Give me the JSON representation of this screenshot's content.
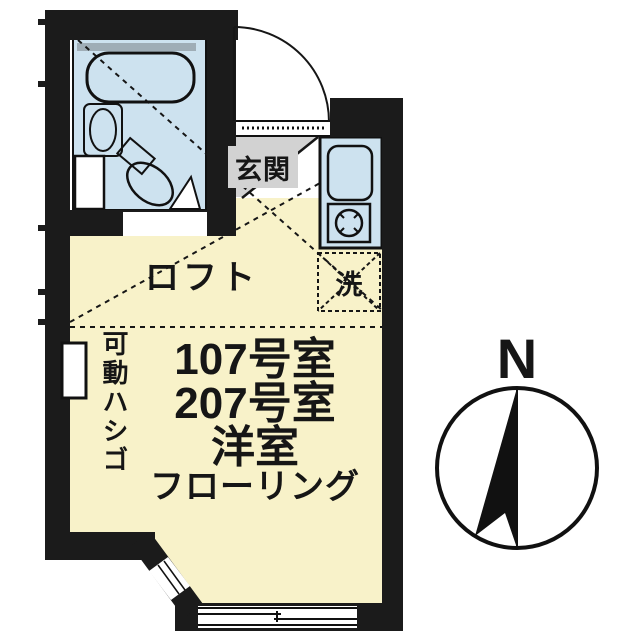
{
  "labels": {
    "entrance": "玄関",
    "washer": "洗",
    "loft": "ロフト",
    "ladder": "可動ハシゴ",
    "room_line1": "107号室",
    "room_line2": "207号室",
    "room_line3": "洋室",
    "room_line4": "フローリング"
  },
  "compass": {
    "north": "N"
  },
  "colors": {
    "wall": "#1b1b1b",
    "floor": "#f8f2c9",
    "wet": "#cde2ef",
    "gray": "#d2d2d2"
  }
}
